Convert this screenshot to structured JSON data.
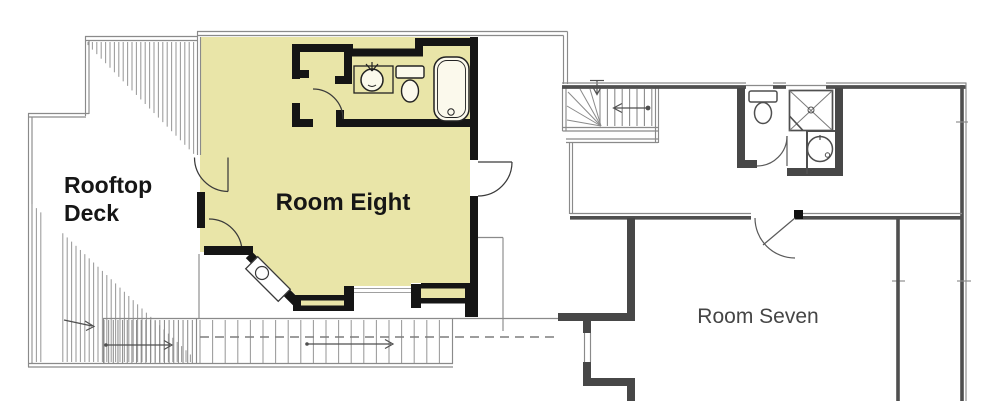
{
  "floorplan": {
    "labels": {
      "deck_line1": "Rooftop",
      "deck_line2": "Deck",
      "room_eight": "Room Eight",
      "room_seven": "Room Seven"
    },
    "colors": {
      "room_fill": "#e9e5a8",
      "interior_wall": "#151515",
      "section_wall": "#4a4a4a",
      "outline_gray": "#8a8a8a",
      "label_dark": "#161616",
      "label_gray": "#454545",
      "background": "#ffffff"
    }
  }
}
